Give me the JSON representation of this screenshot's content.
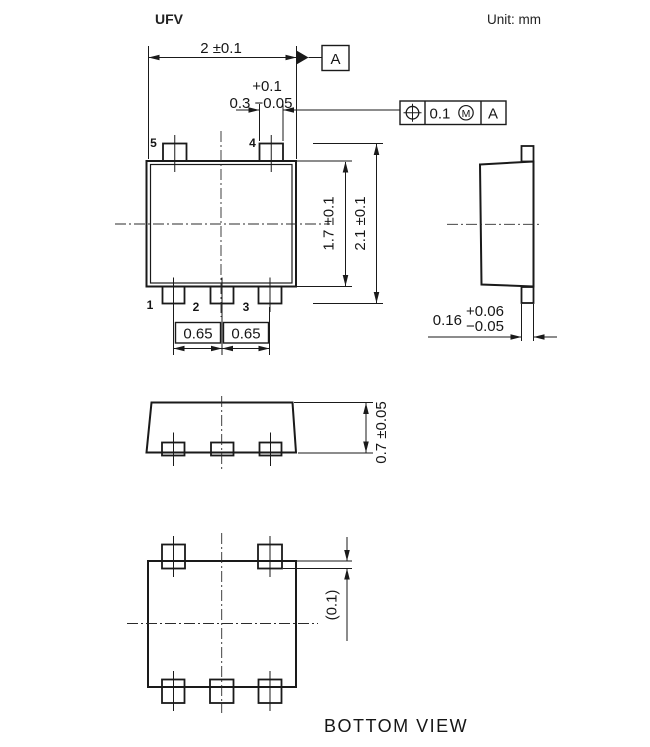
{
  "header": {
    "title": "UFV",
    "unit": "Unit:  mm"
  },
  "colors": {
    "line": "#1a1a1a",
    "background": "#ffffff"
  },
  "top_view": {
    "pins": {
      "p5": "5",
      "p4": "4",
      "p1": "1",
      "p2": "2",
      "p3": "3"
    },
    "dims": {
      "body_width": "2 ±0.1",
      "lead_width_plus": "+0.1",
      "lead_width": "0.3 −0.05",
      "body_length": "1.7 ±0.1",
      "overall_length": "2.1 ±0.1",
      "pitch_left": "0.65",
      "pitch_right": "0.65"
    },
    "datum": "A"
  },
  "fcf": {
    "tolerance": "0.1",
    "modifier": "M",
    "datum": "A"
  },
  "side_view": {
    "dims": {
      "lead_thickness": "0.16",
      "plus": "+0.06",
      "minus": "−0.05"
    }
  },
  "front_view": {
    "dims": {
      "height": "0.7 ±0.05"
    }
  },
  "bottom_view": {
    "dims": {
      "lead_end": "(0.1)"
    },
    "caption": "BOTTOM VIEW"
  }
}
